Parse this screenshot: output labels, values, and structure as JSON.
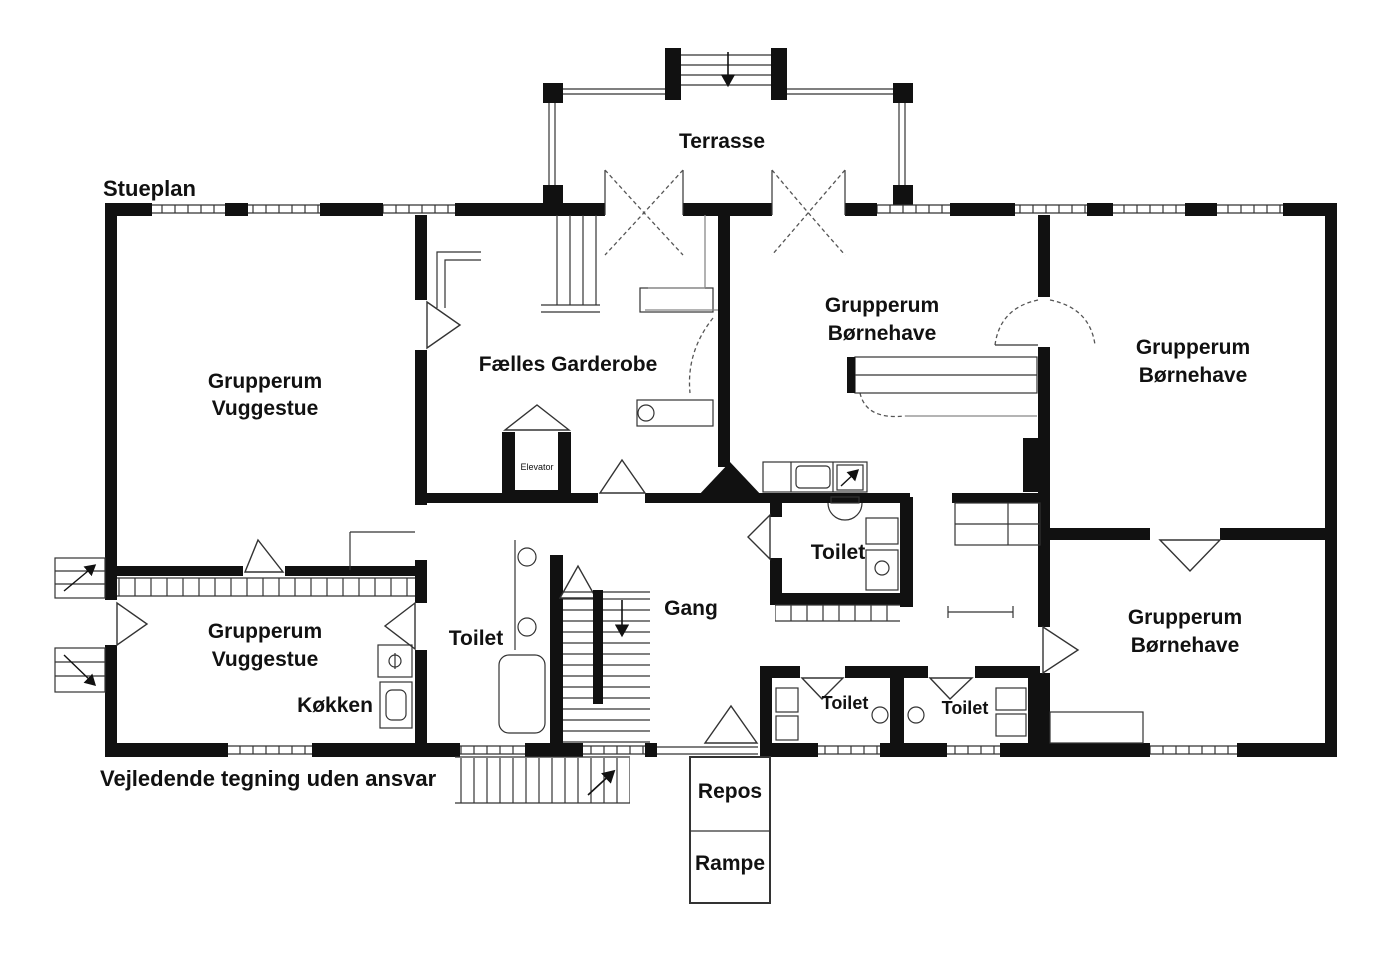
{
  "title": "Stueplan",
  "footer_note": "Vejledende tegning uden ansvar",
  "terrace_label": "Terrasse",
  "landing_label": "Repos",
  "ramp_label": "Rampe",
  "rooms": {
    "vuggestue_top": {
      "line1": "Grupperum",
      "line2": "Vuggestue"
    },
    "vuggestue_bottom": {
      "line1": "Grupperum",
      "line2": "Vuggestue"
    },
    "garderobe": {
      "label": "Fælles Garderobe"
    },
    "bornehave_mid": {
      "line1": "Grupperum",
      "line2": "Børnehave"
    },
    "bornehave_right_top": {
      "line1": "Grupperum",
      "line2": "Børnehave"
    },
    "bornehave_right_bottom": {
      "line1": "Grupperum",
      "line2": "Børnehave"
    },
    "kitchen": {
      "label": "Køkken"
    },
    "hallway": {
      "label": "Gang"
    },
    "toilet_west": {
      "label": "Toilet"
    },
    "toilet_mid": {
      "label": "Toilet"
    },
    "toilet_south_left": {
      "label": "Toilet"
    },
    "toilet_south_right": {
      "label": "Toilet"
    },
    "elevator": {
      "label": "Elevator"
    }
  },
  "colors": {
    "wall": "#111111",
    "line": "#333333",
    "background": "#ffffff"
  }
}
